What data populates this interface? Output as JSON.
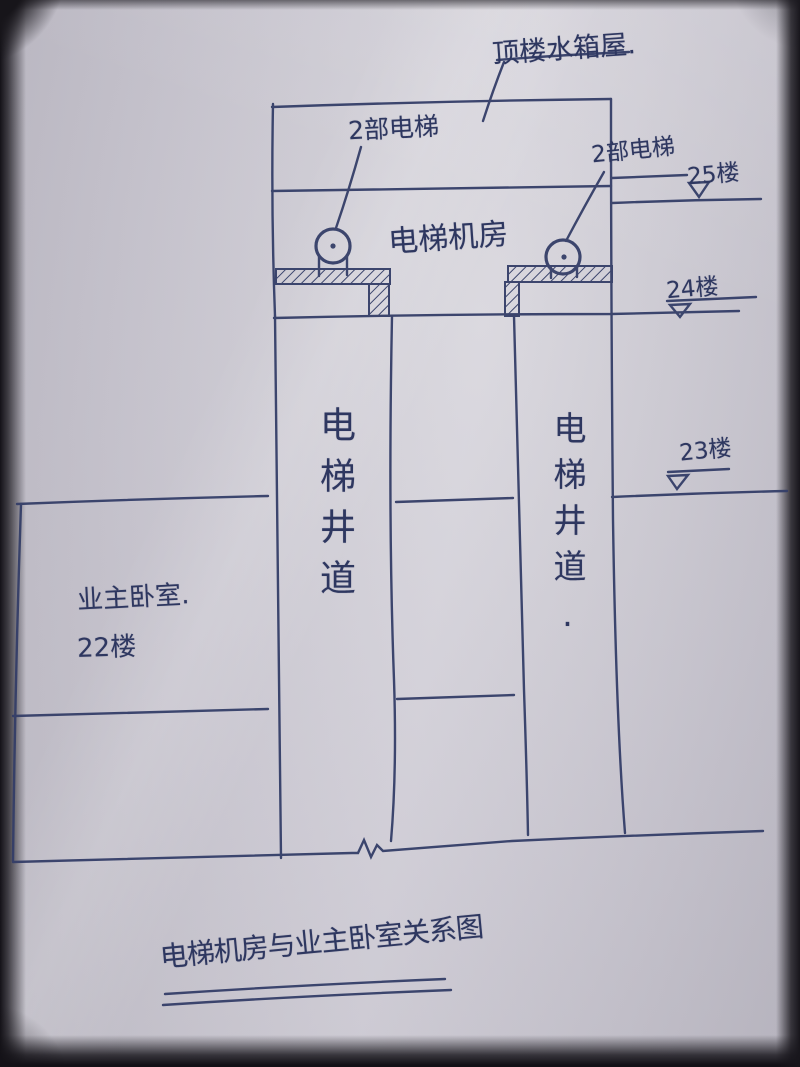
{
  "title": "电梯机房与业主卧室关系图",
  "colors": {
    "ink": "#343e68",
    "paper": "#c9c6cf"
  },
  "labels": {
    "roof_tank_room": "顶楼水箱屋.",
    "left_elevators": "2部电梯",
    "right_elevators": "2部电梯",
    "machine_room": "电梯机房",
    "left_shaft": "电梯井道",
    "right_shaft": "电梯井道.",
    "bedroom": "业主卧室.",
    "bedroom_floor": "22楼"
  },
  "floor_markers": {
    "floor_25": "25楼",
    "floor_24": "24楼",
    "floor_23": "23楼"
  }
}
